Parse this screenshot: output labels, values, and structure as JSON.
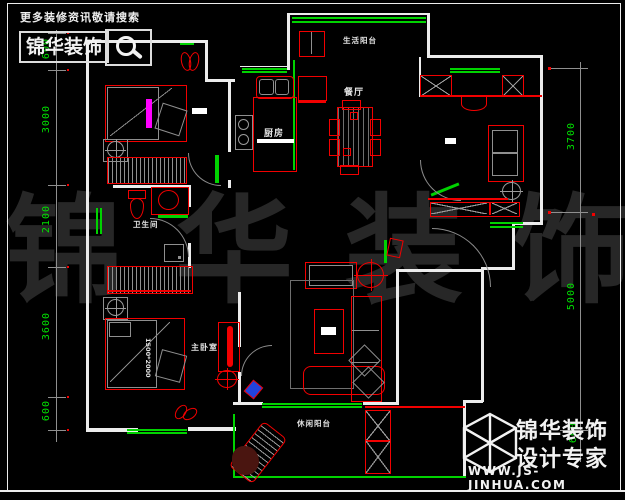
{
  "header": {
    "tagline": "更多装修资讯敬请搜索",
    "brand": "锦华装饰"
  },
  "logo": {
    "brand": "锦华装饰",
    "subtitle": "设计专家",
    "website": "WWW.JS-JINHUA.COM"
  },
  "watermark": [
    "锦",
    "华",
    "装",
    "饰"
  ],
  "rooms": {
    "balcony_top": "生活阳台",
    "dining": "餐厅",
    "kitchen": "厨房",
    "bathroom": "卫生间",
    "master_bedroom": "主卧室",
    "leisure_balcony": "休闲阳台"
  },
  "annotations": {
    "bed_size": "1500*2000"
  },
  "dimensions": {
    "left": [
      "600",
      "3000",
      "2100",
      "3600",
      "600"
    ],
    "right": [
      "3700",
      "5000",
      "600"
    ]
  },
  "colors": {
    "background": "#000000",
    "wall": "#ececec",
    "furniture_red": "#f20000",
    "window_green": "#00d300",
    "dimension_green": "#00e100",
    "detail_grey": "#8f8f8f",
    "accent_magenta": "#ff00ff"
  }
}
